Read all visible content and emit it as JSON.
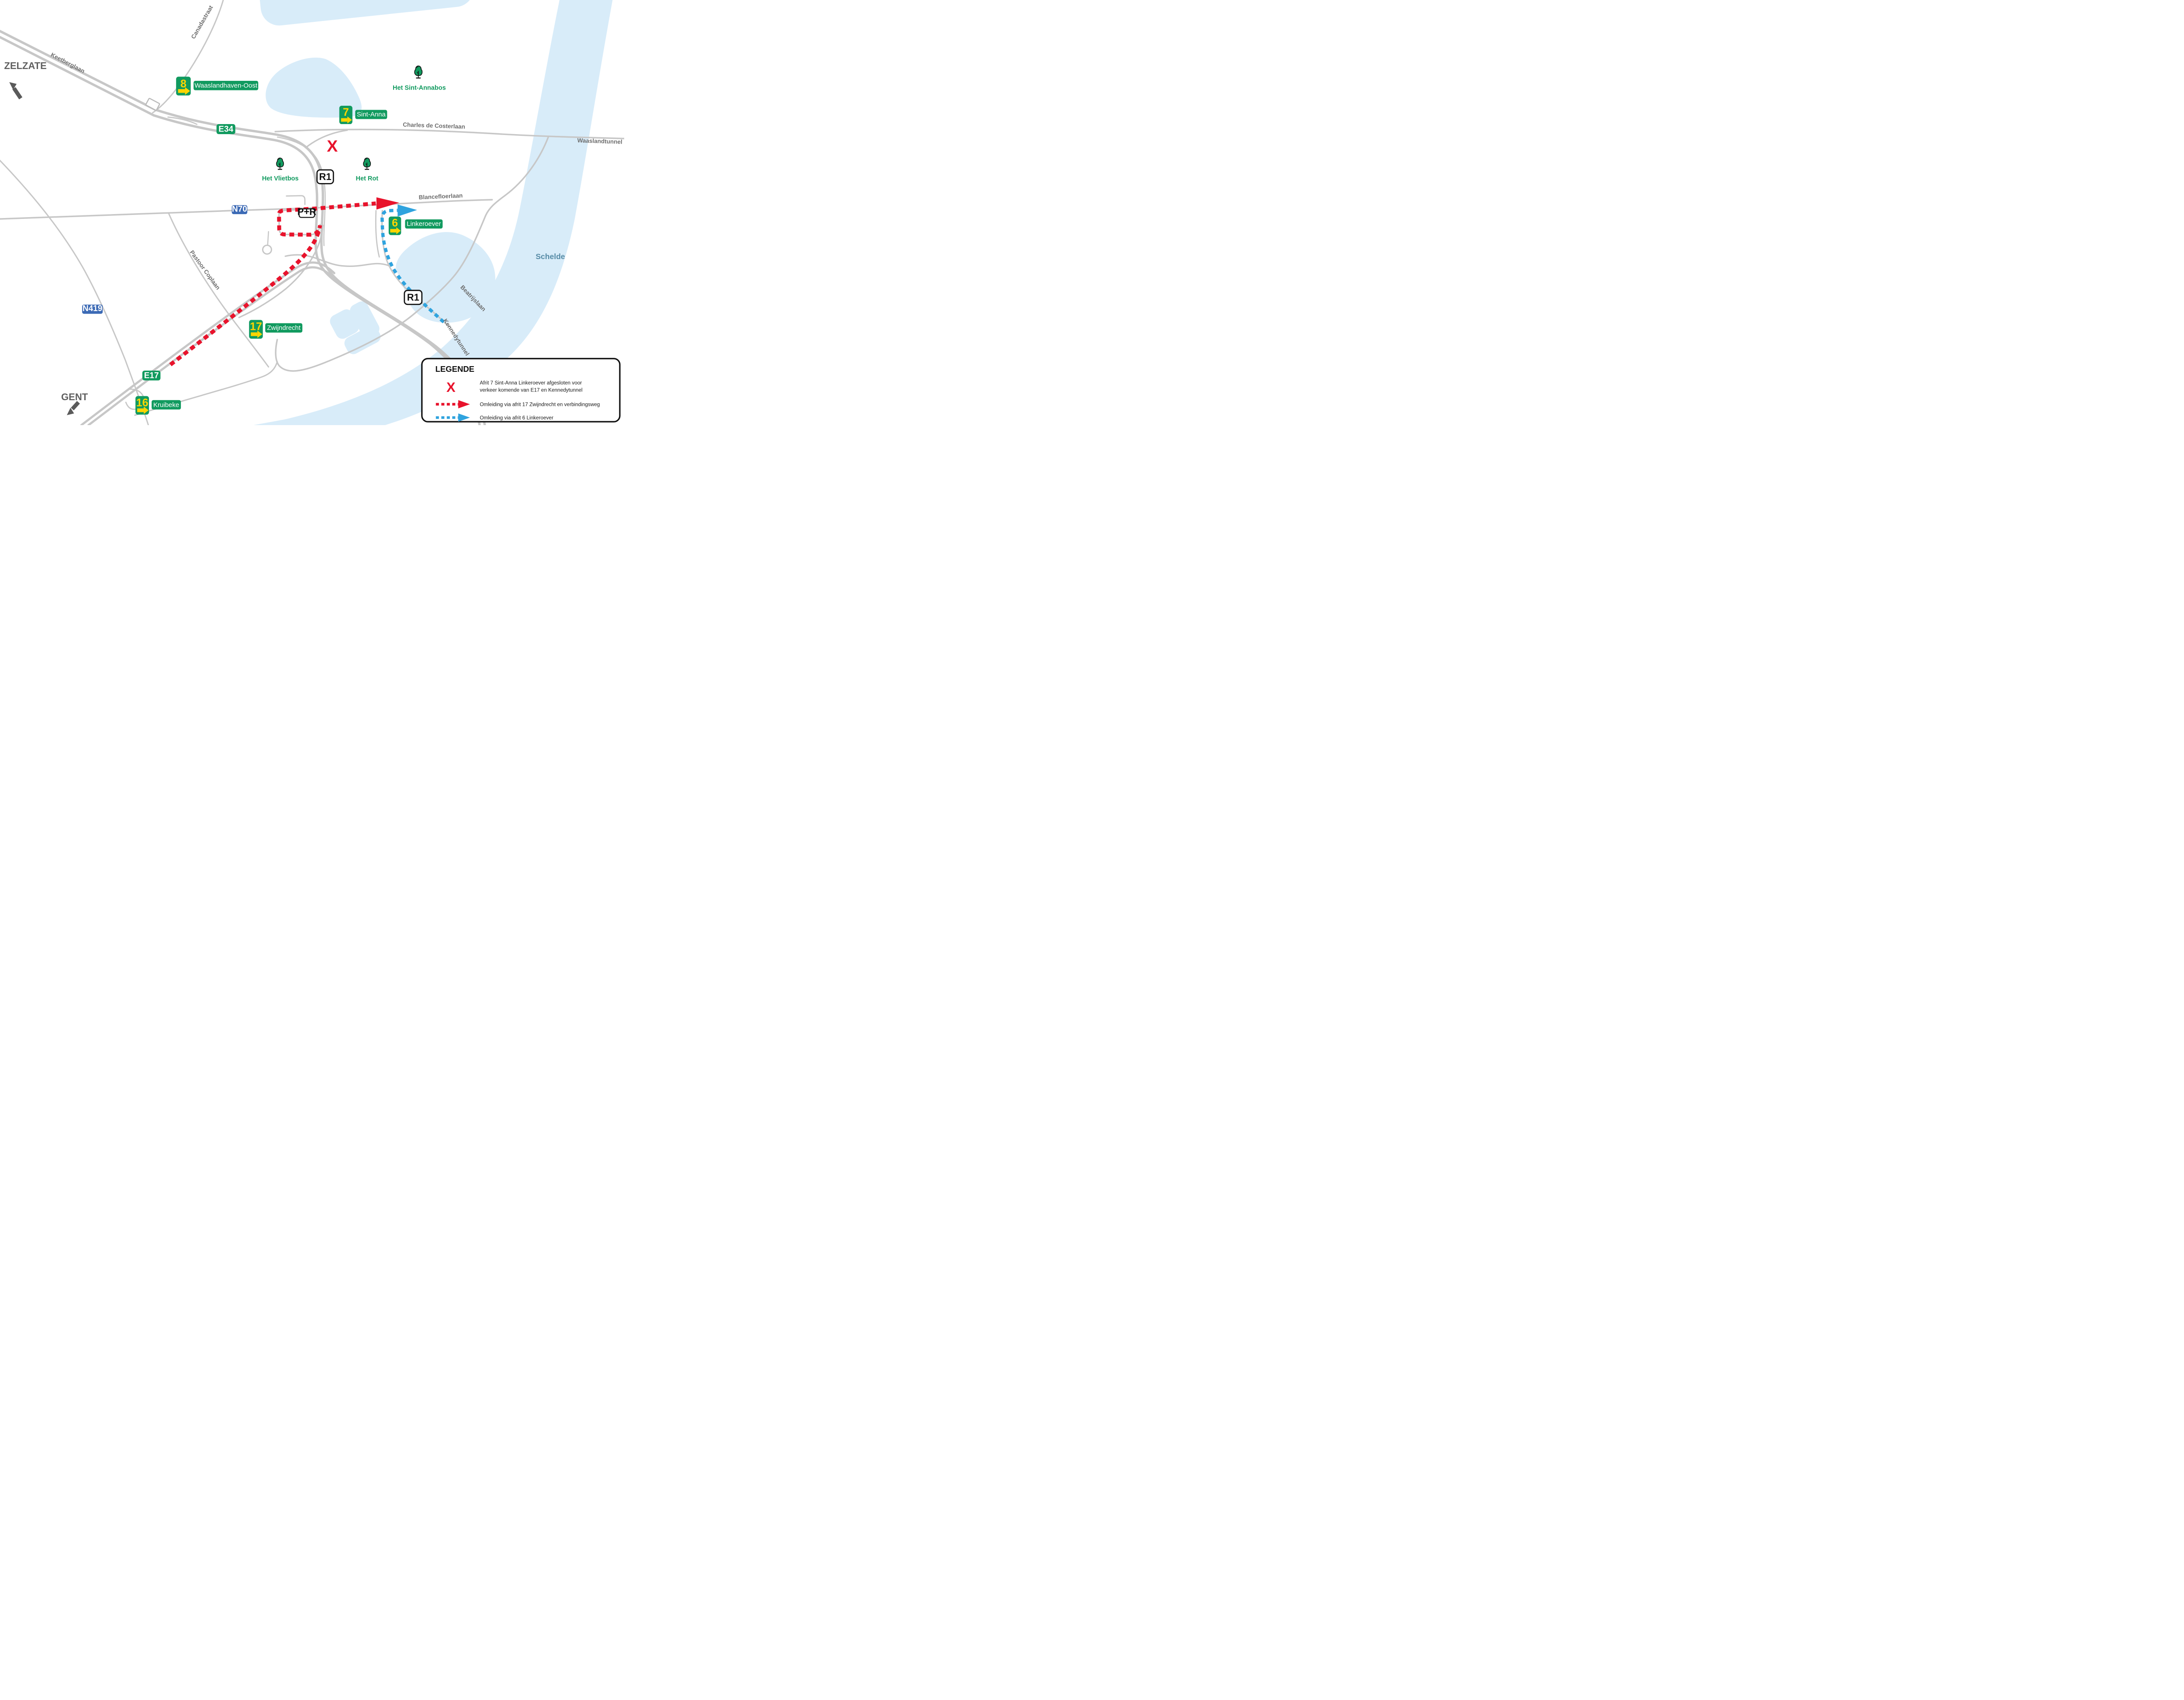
{
  "map": {
    "directions": {
      "zelzate": "ZELZATE",
      "gent": "GENT"
    },
    "streets": {
      "canadastraat": "Canadastraat",
      "keetberglaan": "Keetberglaan",
      "charles_de_costerlaan": "Charles de Costerlaan",
      "waaslandtunnel": "Waaslandtunnel",
      "blancefloerlaan": "Blancefloerlaan",
      "pastoor_coplaan": "Pastoor Coplaan",
      "beatrijslaan": "Beatrijslaan",
      "kennedytunnel": "Kennedytunnel"
    },
    "water": {
      "schelde": "Schelde"
    },
    "forests": {
      "sint_annabos": "Het Sint-Annabos",
      "vlietbos": "Het Vlietbos",
      "rot": "Het Rot"
    },
    "shields": {
      "e34": "E34",
      "e17": "E17",
      "r1": "R1",
      "n70": "N70",
      "n419": "N419",
      "pr": "P+R"
    },
    "exits": [
      {
        "number": "8",
        "name": "Waaslandhaven-Oost"
      },
      {
        "number": "7",
        "name": "Sint-Anna"
      },
      {
        "number": "6",
        "name": "Linkeroever"
      },
      {
        "number": "17",
        "name": "Zwijndrecht"
      },
      {
        "number": "16",
        "name": "Kruibeke"
      }
    ],
    "closure_symbol": "X"
  },
  "legend": {
    "title": "LEGENDE",
    "closed_item": {
      "symbol": "X",
      "line1": "Afrit 7 Sint-Anna Linkeroever afgesloten voor",
      "line2": "verkeer komende van E17 en Kennedytunnel"
    },
    "red_item": {
      "text": "Omleiding via afrit 17 Zwijndrecht en verbindingsweg"
    },
    "blue_item": {
      "text": "Omleiding via afrit 6 Linkeroever"
    }
  },
  "colors": {
    "sign_green": "#119a5f",
    "sign_yellow": "#ffd500",
    "route_red": "#e8132c",
    "route_blue": "#2fa3de",
    "water": "#d8ecf9",
    "road_gray": "#c7c7c7",
    "shield_blue": "#3c6ab5"
  }
}
